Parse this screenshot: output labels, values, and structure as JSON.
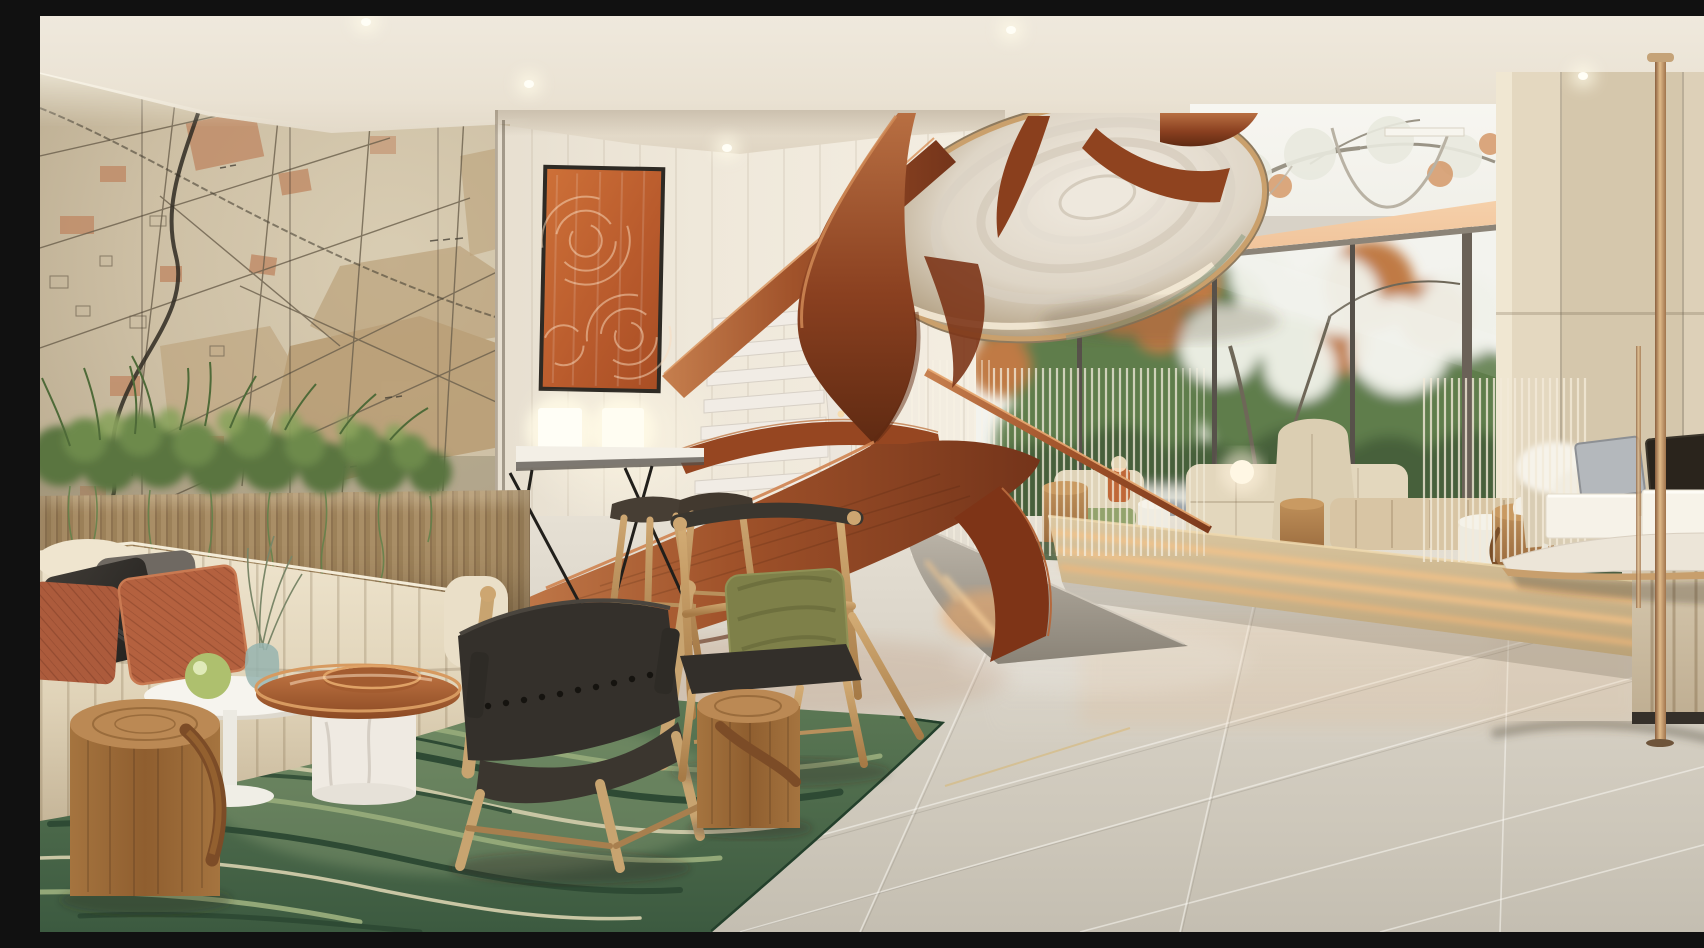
{
  "scene": {
    "caption": "Photorealistic rendering of a hotel lobby lounge with a sculptural copper spiral staircase, vintage map mural wall, green abstract rug, cream seating and floor-to-ceiling windows onto flowering trees",
    "room_type": "hotel lobby lounge",
    "style": "contemporary tropical-modern interior rendering",
    "time_of_day": "daytime"
  },
  "palette": {
    "ceiling_cream": "#eae2d3",
    "map_wall_tan": "#cdbfa4",
    "map_patch_brown": "#b79b72",
    "map_block_terracotta": "#c08a66",
    "panel_wall_ivory": "#efe8da",
    "copper_ribbon": "#a0522a",
    "copper_highlight": "#d08a56",
    "marble_step": "#f1ece5",
    "disc_chrome": "#ded5c6",
    "window_green": "#5e7d4b",
    "window_orange": "#c07a45",
    "blossom_white": "#f1f2ea",
    "soffit_peach": "#f3c9a2",
    "travertine": "#d5c7ac",
    "floor_tile": "#d6d0c4",
    "rug_green_dark": "#3c5a40",
    "rug_green_light": "#93a878",
    "rug_cream": "#cfcbaa",
    "sofa_cream": "#e6dcc6",
    "pillow_terracotta": "#b2603e",
    "pillow_black": "#2c2a27",
    "oak_wood": "#c39b66",
    "stump_wood": "#a5743f",
    "leather_strap": "#7a4a26",
    "olive_cushion": "#7e8049",
    "brass_pole": "#c49a6a",
    "led_warm_glow": "#f2b377"
  },
  "objects": [
    {
      "name": "map-mural",
      "label": "vintage city map mural on left wall"
    },
    {
      "name": "cove-light",
      "label": "cove lighting along ceiling edge"
    },
    {
      "name": "abstract-artwork",
      "label": "orange abstract artwork on paneled wall"
    },
    {
      "name": "console-table",
      "label": "wall console with two glowing cube lamps"
    },
    {
      "name": "bar-stools",
      "label": "two oak bar stools with dark seats"
    },
    {
      "name": "spiral-staircase",
      "label": "sculptural copper ribbon spiral stair with marble treads"
    },
    {
      "name": "stair-disc",
      "label": "polished underside of upper stair landing"
    },
    {
      "name": "glass-balustrade",
      "label": "glass and string balustrade with copper handrail"
    },
    {
      "name": "window-wall",
      "label": "floor-to-ceiling glazing with flowering trees outside"
    },
    {
      "name": "elevated-lounge",
      "label": "raised lounge platform with wingback chairs and sofa"
    },
    {
      "name": "backlit-steps",
      "label": "wide steps with warm LED under treads"
    },
    {
      "name": "reception-desk",
      "label": "round reception desk with monitors and backlit blocks"
    },
    {
      "name": "brass-poles",
      "label": "floor-to-ceiling brass poles"
    },
    {
      "name": "planter-wall",
      "label": "wood slat planter with ferns and trailing vines"
    },
    {
      "name": "sofa",
      "label": "cream channel-tufted sofa with terracotta and black pillows"
    },
    {
      "name": "side-tables",
      "label": "white pedestal table and copper tray table"
    },
    {
      "name": "log-stools",
      "label": "solid log stools with leather straps"
    },
    {
      "name": "lounge-chairs",
      "label": "oak lounge chairs with black leather and olive cushion"
    },
    {
      "name": "area-rug",
      "label": "green marble-pattern area rug"
    },
    {
      "name": "tile-floor",
      "label": "large-format light stone tile floor"
    }
  ]
}
